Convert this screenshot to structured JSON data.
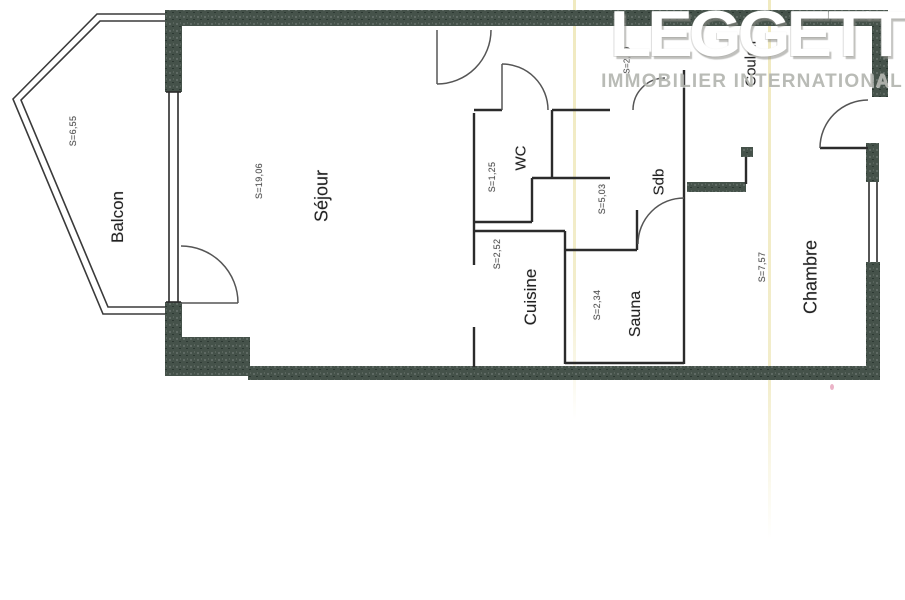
{
  "logo": {
    "brand": "LEGGETT",
    "tagline": "IMMOBILIER INTERNATIONAL"
  },
  "rooms": [
    {
      "id": "balcon",
      "label": "Balcon",
      "area": "S=6,55"
    },
    {
      "id": "sejour",
      "label": "Séjour",
      "area": "S=19,06"
    },
    {
      "id": "wc",
      "label": "WC",
      "area": "S=1,25"
    },
    {
      "id": "sdb",
      "label": "Sdb",
      "area": "S=5,03"
    },
    {
      "id": "cuisine",
      "label": "Cuisine",
      "area": "S=2,52"
    },
    {
      "id": "sauna",
      "label": "Sauna",
      "area": "S=2,34"
    },
    {
      "id": "chambre",
      "label": "Chambre",
      "area": "S=7,57"
    },
    {
      "id": "couloir",
      "label": "Couloir",
      "area": "S=2,99"
    }
  ],
  "colors": {
    "wall": "#45524a",
    "thin_line": "#2b2b2b",
    "door_arc": "#555555",
    "logo_brand": "#ffffff",
    "logo_tagline": "#b4b6b0",
    "room_label": "#222222",
    "area_label": "#4a4a4a",
    "scan_fold_line": "#e4d88c"
  }
}
